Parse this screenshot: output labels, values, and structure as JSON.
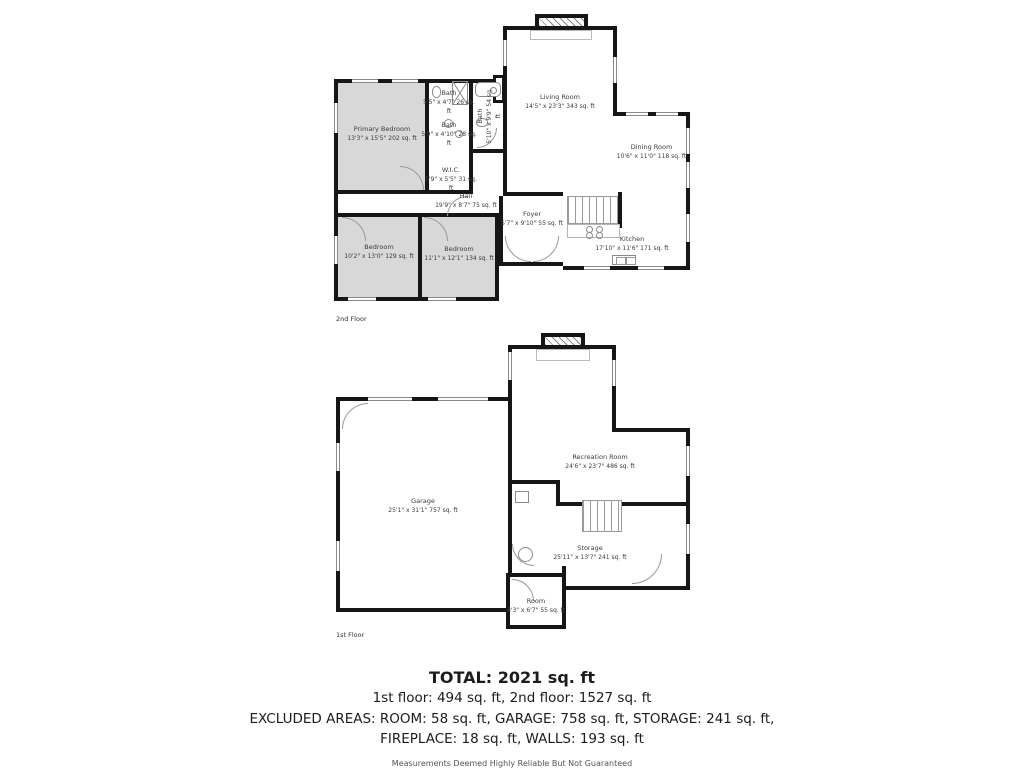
{
  "colors": {
    "wall": "#161616",
    "room_fill": "#d8d8d8",
    "background": "#ffffff"
  },
  "floors": [
    {
      "name": "2nd Floor",
      "rooms": [
        {
          "label": "Primary Bedroom",
          "dims": "13'3\" x 15'5\" 202 sq. ft"
        },
        {
          "label": "Bath",
          "dims": "5'5\" x 4'7\" 26 sq. ft"
        },
        {
          "label": "Bath",
          "dims": "5'9\" x 4'10\" 28 sq. ft"
        },
        {
          "label": "Bath",
          "dims": "5'10\" x 9'9\" 54 sq. ft"
        },
        {
          "label": "W.I.C.",
          "dims": "5'9\" x 5'5\" 31 sq. ft"
        },
        {
          "label": "Hall",
          "dims": "19'9\" x 8'7\" 75 sq. ft"
        },
        {
          "label": "Living Room",
          "dims": "14'5\" x 23'3\" 343 sq. ft"
        },
        {
          "label": "Dining Room",
          "dims": "10'6\" x 11'0\" 118 sq. ft"
        },
        {
          "label": "Foyer",
          "dims": "5'7\" x 9'10\" 55 sq. ft"
        },
        {
          "label": "Kitchen",
          "dims": "17'10\" x 11'6\" 171 sq. ft"
        },
        {
          "label": "Bedroom",
          "dims": "10'2\" x 13'0\" 129 sq. ft"
        },
        {
          "label": "Bedroom",
          "dims": "11'1\" x 12'1\" 134 sq. ft"
        }
      ]
    },
    {
      "name": "1st Floor",
      "rooms": [
        {
          "label": "Garage",
          "dims": "25'1\" x 31'1\" 757 sq. ft"
        },
        {
          "label": "Recreation Room",
          "dims": "24'6\" x 23'7\" 486 sq. ft"
        },
        {
          "label": "Storage",
          "dims": "25'11\" x 13'7\" 241 sq. ft"
        },
        {
          "label": "Room",
          "dims": "8'3\" x 6'7\" 55 sq. ft"
        }
      ]
    }
  ],
  "summary": {
    "total": "TOTAL: 2021 sq. ft",
    "floors_line": "1st floor: 494 sq. ft, 2nd floor: 1527 sq. ft",
    "excluded_line1": "EXCLUDED AREAS: ROOM: 58 sq. ft, GARAGE: 758 sq. ft, STORAGE: 241 sq. ft,",
    "excluded_line2": "FIREPLACE: 18 sq. ft, WALLS: 193 sq. ft",
    "disclaimer": "Measurements Deemed Highly Reliable But Not Guaranteed"
  }
}
